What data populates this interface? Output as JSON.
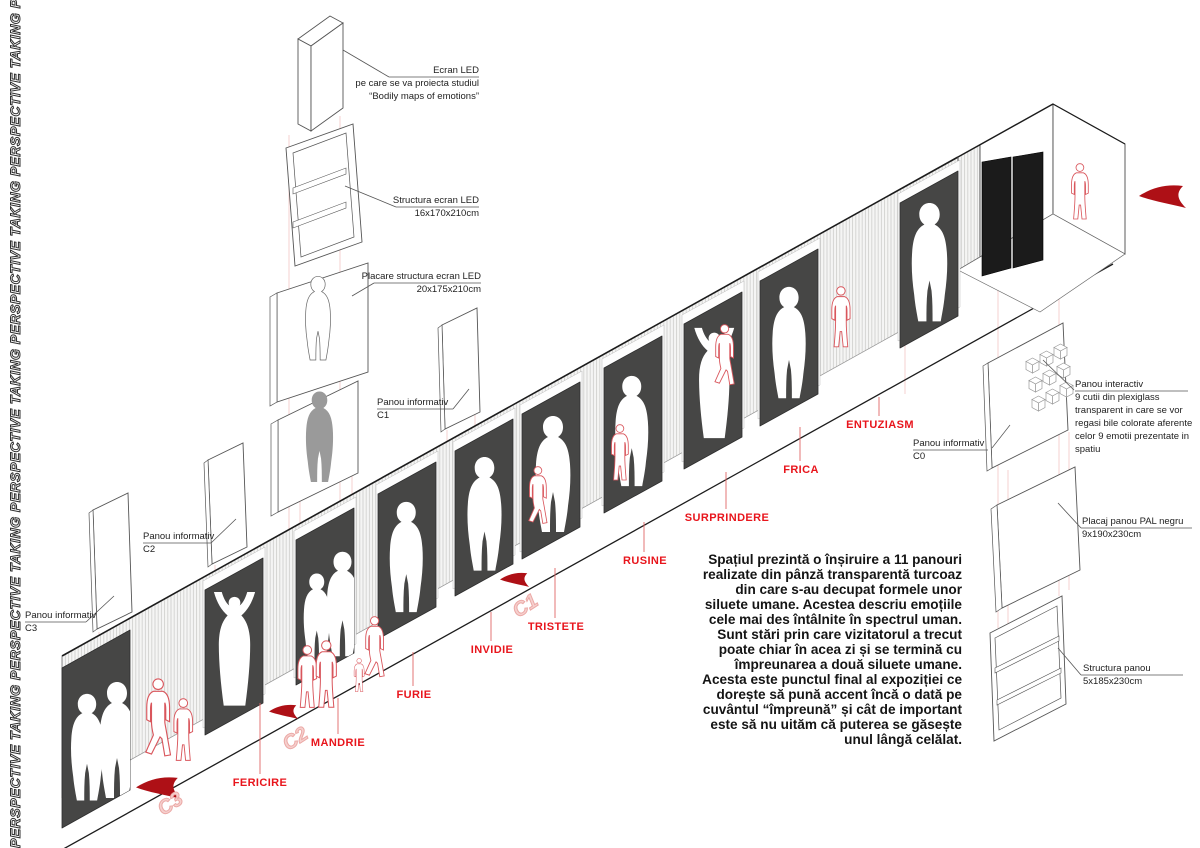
{
  "side_text": "PERSPECTIVE TAKING  PERSPECTIVE TAKING  PERSPECTIVE TAKING  PERSPECTIVE TAKING  PERSPECTIVE TAKING  PERSPECTIVE TAKING",
  "annotations": {
    "ecran_led": {
      "text": "Ecran LED\npe care se va proiecta studiul\n“Bodily maps of emotions”"
    },
    "structura_ecran_led": {
      "text": "Structura ecran LED\n16x170x210cm"
    },
    "placare_structura": {
      "text": "Placare structura ecran LED\n20x175x210cm"
    },
    "panou_informativ_c1": {
      "text": "Panou informativ\nC1"
    },
    "panou_informativ_c2": {
      "text": "Panou informativ\nC2"
    },
    "panou_informativ_c3": {
      "text": "Panou informativ\nC3"
    },
    "panou_informativ_c0": {
      "text": "Panou informativ\nC0"
    },
    "panou_interactiv": {
      "text": "Panou interactiv\n9 cutii din plexiglass\ntransparent in care se vor\nregasi bile colorate aferente\ncelor 9 emotii prezentate in\nspatiu"
    },
    "placaj_pal": {
      "text": "Placaj panou PAL negru\n9x190x230cm"
    },
    "structura_panou": {
      "text": "Structura panou\n5x185x230cm"
    }
  },
  "emotions": [
    {
      "label": "FERICIRE"
    },
    {
      "label": "MANDRIE"
    },
    {
      "label": "FURIE"
    },
    {
      "label": "INVIDIE"
    },
    {
      "label": "TRISTETE"
    },
    {
      "label": "RUSINE"
    },
    {
      "label": "SURPRINDERE"
    },
    {
      "label": "FRICA"
    },
    {
      "label": "ENTUZIASM"
    }
  ],
  "markers": {
    "c1": "C1",
    "c2": "C2",
    "c3": "C3"
  },
  "description": {
    "text": "Spațiul prezintă o înșiruire a 11 panouri\nrealizate din pânză transparentă turcoaz\ndin care s-au decupat formele unor\nsiluete umane. Acestea descriu emoțiile\ncele mai des întâlnite în spectrul uman.\nSunt stări prin care vizitatorul a trecut\npoate chiar în acea zi și se termină cu\nîmpreunarea a două siluete umane.\nAcesta este punctul final al expoziției ce\ndorește să pună accent încă o dată pe\ncuvântul “împreună” și cât de important\neste să nu uităm că puterea se găsește\nunul lângă celălat."
  },
  "colors": {
    "accent_red": "#e8151c",
    "arrow_red": "#ae1016",
    "figure_red": "#d9565c",
    "panel_dark": "#464645",
    "ghost_pink": "#eba9a6",
    "hatch_gray": "#d2d2d0"
  }
}
